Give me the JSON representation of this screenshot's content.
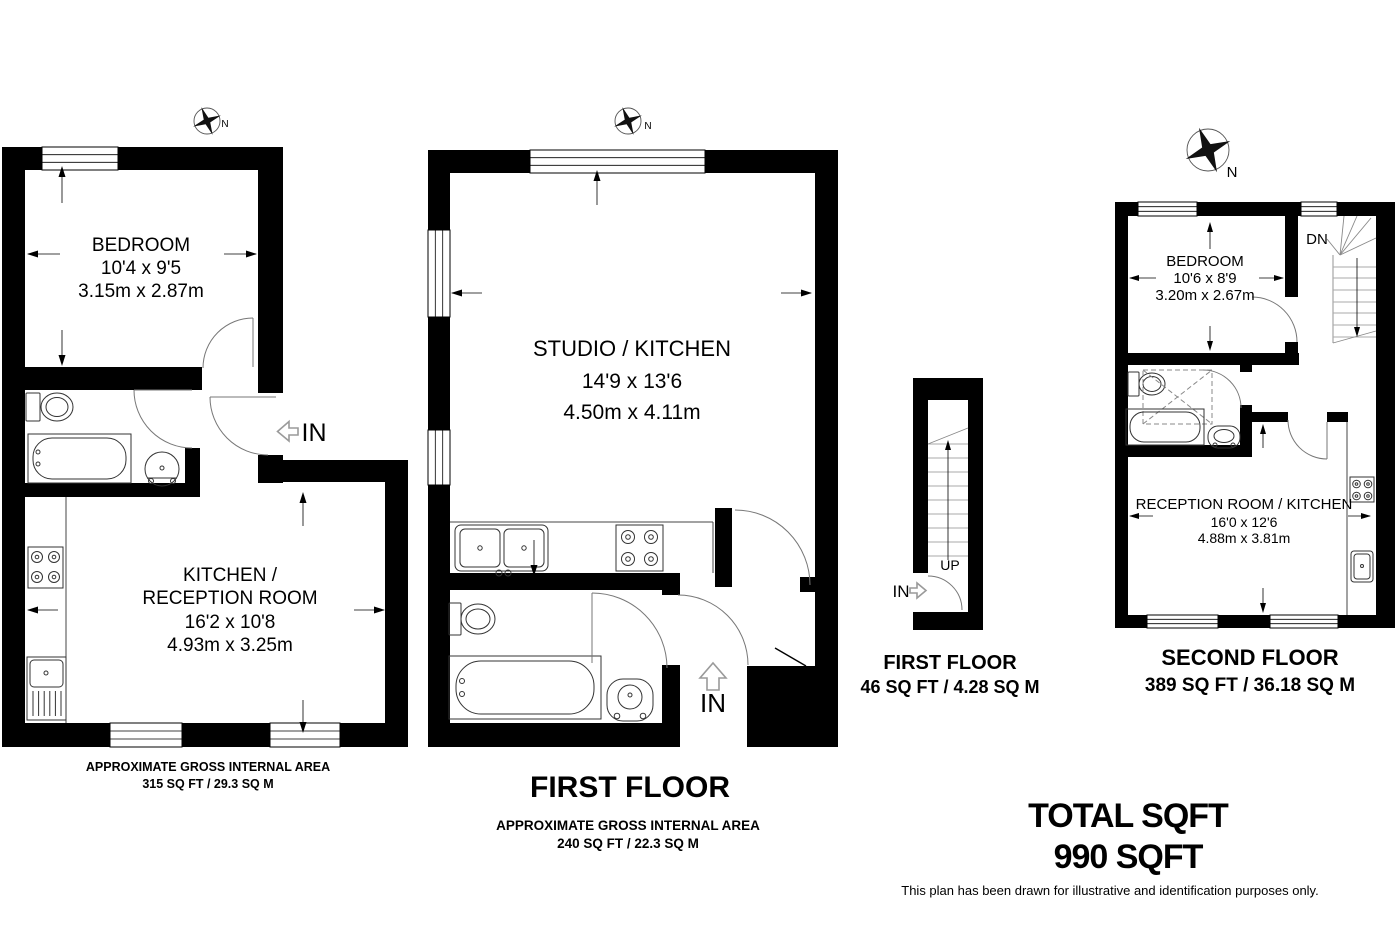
{
  "page": {
    "disclaimer": "This plan has been drawn for illustrative and identification purposes only.",
    "ink_color": "#000000",
    "background": "#ffffff"
  },
  "compass": {
    "label": "N"
  },
  "total": {
    "line1": "TOTAL SQFT",
    "line2": "990 SQFT"
  },
  "plan_left": {
    "bedroom": {
      "name": "BEDROOM",
      "imperial": "10'4 x 9'5",
      "metric": "3.15m x 2.87m"
    },
    "kitchen": {
      "name_line1": "KITCHEN /",
      "name_line2": "RECEPTION ROOM",
      "imperial": "16'2 x 10'8",
      "metric": "4.93m x 3.25m"
    },
    "entry": "IN",
    "area_line1": "APPROXIMATE GROSS INTERNAL AREA",
    "area_line2": "315 SQ FT / 29.3 SQ M"
  },
  "plan_middle": {
    "title": "FIRST FLOOR",
    "studio": {
      "name": "STUDIO / KITCHEN",
      "imperial": "14'9 x 13'6",
      "metric": "4.50m x 4.11m"
    },
    "entry": "IN",
    "area_line1": "APPROXIMATE GROSS INTERNAL AREA",
    "area_line2": "240 SQ FT / 22.3 SQ M"
  },
  "plan_stairs": {
    "title": "FIRST FLOOR",
    "area": "46 SQ FT / 4.28 SQ M",
    "up_label": "UP",
    "entry": "IN"
  },
  "plan_right": {
    "title": "SECOND FLOOR",
    "area": "389 SQ FT / 36.18 SQ M",
    "bedroom": {
      "name": "BEDROOM",
      "imperial": "10'6 x 8'9",
      "metric": "3.20m x 2.67m"
    },
    "reception": {
      "name": "RECEPTION ROOM / KITCHEN",
      "imperial": "16'0 x 12'6",
      "metric": "4.88m x 3.81m"
    },
    "down_label": "DN"
  }
}
